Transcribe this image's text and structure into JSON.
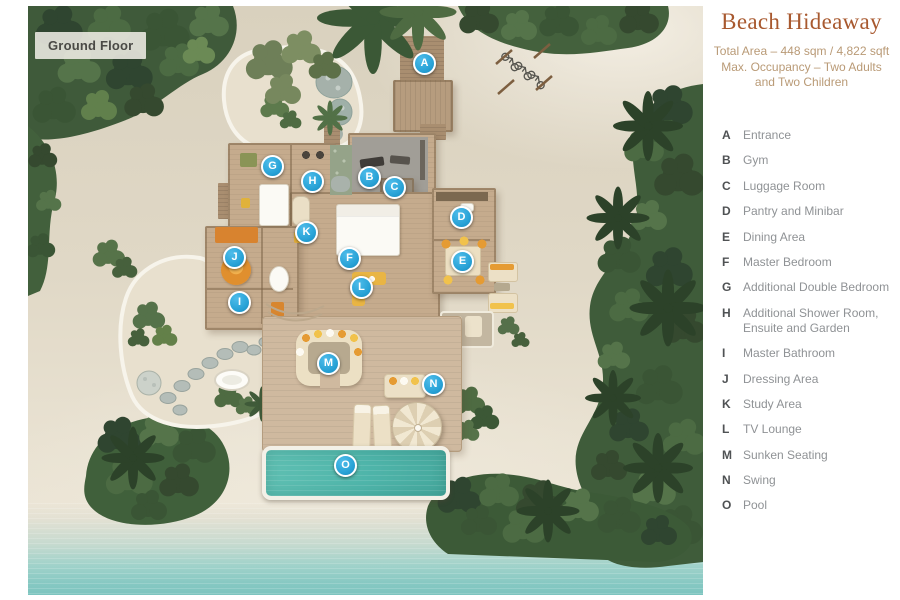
{
  "floorplan": {
    "badge": "Ground Floor",
    "markers": [
      {
        "letter": "A",
        "x": 424,
        "y": 63
      },
      {
        "letter": "B",
        "x": 369,
        "y": 177
      },
      {
        "letter": "C",
        "x": 394,
        "y": 187
      },
      {
        "letter": "D",
        "x": 461,
        "y": 217
      },
      {
        "letter": "E",
        "x": 462,
        "y": 261
      },
      {
        "letter": "F",
        "x": 349,
        "y": 258
      },
      {
        "letter": "G",
        "x": 272,
        "y": 166
      },
      {
        "letter": "H",
        "x": 312,
        "y": 181
      },
      {
        "letter": "I",
        "x": 239,
        "y": 302
      },
      {
        "letter": "J",
        "x": 234,
        "y": 257
      },
      {
        "letter": "K",
        "x": 306,
        "y": 232
      },
      {
        "letter": "L",
        "x": 361,
        "y": 287
      },
      {
        "letter": "M",
        "x": 328,
        "y": 363
      },
      {
        "letter": "N",
        "x": 433,
        "y": 384
      },
      {
        "letter": "O",
        "x": 345,
        "y": 465
      }
    ]
  },
  "panel": {
    "title": "Beach Hideaway",
    "subtitle_lines": [
      "Total Area – 448 sqm / 4,822 sqft",
      "Max. Occupancy – Two Adults",
      "and Two Children"
    ],
    "legend": [
      {
        "key": "A",
        "label": "Entrance"
      },
      {
        "key": "B",
        "label": "Gym"
      },
      {
        "key": "C",
        "label": "Luggage Room"
      },
      {
        "key": "D",
        "label": "Pantry and Minibar"
      },
      {
        "key": "E",
        "label": "Dining Area"
      },
      {
        "key": "F",
        "label": "Master Bedroom"
      },
      {
        "key": "G",
        "label": "Additional Double Bedroom"
      },
      {
        "key": "H",
        "label": "Additional Shower Room, Ensuite and Garden"
      },
      {
        "key": "I",
        "label": "Master Bathroom"
      },
      {
        "key": "J",
        "label": "Dressing Area"
      },
      {
        "key": "K",
        "label": "Study Area"
      },
      {
        "key": "L",
        "label": "TV Lounge"
      },
      {
        "key": "M",
        "label": "Sunken Seating"
      },
      {
        "key": "N",
        "label": "Swing"
      },
      {
        "key": "O",
        "label": "Pool"
      }
    ]
  },
  "colors": {
    "title_text": "#a8592f",
    "subtitle_text": "#b99a76",
    "legend_key": "#4f5254",
    "legend_label": "#8f9295",
    "marker_blue": "#28a2d6",
    "pool_teal": "#4fb5aa",
    "sea_teal": "#7cc4bf",
    "badge_text": "#4a4a46"
  }
}
